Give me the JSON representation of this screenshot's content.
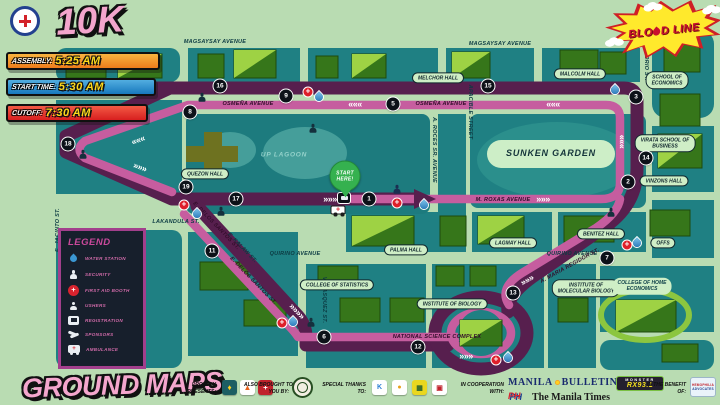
{
  "page": {
    "bg": "#b9dcb2",
    "map_teal": "#1f8083",
    "route_purple": "#571f4e",
    "route_pink": "#c65d9f"
  },
  "header": {
    "distance_badge": "10K",
    "schedule": [
      {
        "label": "ASSEMBLY:",
        "time": "5:25 AM",
        "c1": "#f9b43f",
        "c2": "#ee7c1b",
        "y": 52,
        "w": 154
      },
      {
        "label": "START TIME:",
        "time": "5:30 AM",
        "c1": "#52aee0",
        "c2": "#1878bd",
        "y": 78,
        "w": 150
      },
      {
        "label": "CUTOFF:",
        "time": "7:30 AM",
        "c1": "#f25a44",
        "c2": "#d81f1f",
        "y": 104,
        "w": 142
      }
    ]
  },
  "event_logo": {
    "t1": "BLO",
    "t2": "D LINE"
  },
  "legend": {
    "title": "LEGEND",
    "items": [
      {
        "icon": "water",
        "label": "WATER STATION"
      },
      {
        "icon": "security",
        "label": "SECURITY"
      },
      {
        "icon": "firstaid",
        "label": "FIRST AID BOOTH"
      },
      {
        "icon": "usher",
        "label": "USHERS"
      },
      {
        "icon": "registration",
        "label": "REGISTRATION"
      },
      {
        "icon": "sponsors",
        "label": "SPONSORS"
      },
      {
        "icon": "ambulance",
        "label": "AMBULANCE"
      }
    ]
  },
  "map": {
    "street_labels": [
      {
        "t": "MAGSAYSAY AVENUE",
        "x": 215,
        "y": 42,
        "r": 0,
        "v": "g"
      },
      {
        "t": "MAGSAYSAY AVENUE",
        "x": 500,
        "y": 44,
        "r": 0,
        "v": "g"
      },
      {
        "t": "OSMEÑA AVENUE",
        "x": 248,
        "y": 104,
        "r": 0,
        "v": "p"
      },
      {
        "t": "OSMEÑA AVENUE",
        "x": 441,
        "y": 104,
        "r": 0,
        "v": "p"
      },
      {
        "t": "M. ROXAS AVENUE",
        "x": 503,
        "y": 200,
        "r": 0,
        "v": "p"
      },
      {
        "t": "NATIONAL SCIENCE COMPLEX",
        "x": 437,
        "y": 337,
        "r": 0,
        "v": "p"
      },
      {
        "t": "LAKANDULA ST.",
        "x": 176,
        "y": 222,
        "r": 0,
        "v": "g"
      },
      {
        "t": "QUIRINO AVENUE",
        "x": 295,
        "y": 254,
        "r": 0,
        "v": "g"
      },
      {
        "t": "QUIRINO AVENUE",
        "x": 572,
        "y": 254,
        "r": 0,
        "v": "g"
      },
      {
        "t": "E. JACINTO ST.",
        "x": 58,
        "y": 230,
        "r": -90,
        "v": "g"
      },
      {
        "t": "A. ROCES SR. AVENUE",
        "x": 434,
        "y": 150,
        "r": 90,
        "v": "g"
      },
      {
        "t": "APACIBLE STREET",
        "x": 470,
        "y": 112,
        "r": 90,
        "v": "g"
      },
      {
        "t": "E. OSORIO ST.",
        "x": 646,
        "y": 60,
        "r": 90,
        "v": "g"
      },
      {
        "t": "VELASQUEZ ST.",
        "x": 324,
        "y": 300,
        "r": 90,
        "v": "g"
      },
      {
        "t": "E. KALAW ST.",
        "x": 242,
        "y": 248,
        "r": 46,
        "v": "g"
      },
      {
        "t": "E. DELOS SANTOS ST.",
        "x": 216,
        "y": 226,
        "r": 46,
        "v": "p"
      },
      {
        "t": "E. DELOS SANTOS ST.",
        "x": 253,
        "y": 281,
        "r": 46,
        "v": "p"
      },
      {
        "t": "A. MARIA REGIDOR ST.",
        "x": 570,
        "y": 266,
        "r": -29,
        "v": "p"
      }
    ],
    "place_labels": [
      {
        "t": "QUEZON HALL",
        "x": 205,
        "y": 174
      },
      {
        "t": "MELCHOR HALL",
        "x": 438,
        "y": 78
      },
      {
        "t": "MALCOLM HALL",
        "x": 580,
        "y": 74
      },
      {
        "t": "SCHOOL OF|ECONOMICS",
        "x": 667,
        "y": 80
      },
      {
        "t": "VIRATA SCHOOL OF|BUSINESS",
        "x": 665,
        "y": 143
      },
      {
        "t": "VINZONS HALL",
        "x": 664,
        "y": 181
      },
      {
        "t": "OFFS",
        "x": 663,
        "y": 243
      },
      {
        "t": "PALMA HALL",
        "x": 406,
        "y": 250
      },
      {
        "t": "LAGMAY HALL",
        "x": 513,
        "y": 243
      },
      {
        "t": "BENITEZ HALL",
        "x": 601,
        "y": 234
      },
      {
        "t": "COLLEGE OF STATISTICS",
        "x": 337,
        "y": 285
      },
      {
        "t": "INSTITUTE OF BIOLOGY",
        "x": 452,
        "y": 304
      },
      {
        "t": "INSTITUTE OF|MOLECULAR BIOLOGY",
        "x": 586,
        "y": 288
      },
      {
        "t": "COLLEGE OF HOME|ECONOMICS",
        "x": 642,
        "y": 286,
        "v": "plain"
      },
      {
        "t": "SUNKEN GARDEN",
        "x": 551,
        "y": 153,
        "v": "big"
      },
      {
        "t": "UP LAGOON",
        "x": 284,
        "y": 155,
        "v": "water"
      }
    ],
    "markers": [
      {
        "n": "18",
        "x": 68,
        "y": 144
      },
      {
        "n": "19",
        "x": 186,
        "y": 187
      },
      {
        "n": "8",
        "x": 190,
        "y": 112
      },
      {
        "n": "16",
        "x": 220,
        "y": 86
      },
      {
        "n": "9",
        "x": 286,
        "y": 96
      },
      {
        "n": "5",
        "x": 393,
        "y": 104
      },
      {
        "n": "15",
        "x": 488,
        "y": 86
      },
      {
        "n": "3",
        "x": 636,
        "y": 97
      },
      {
        "n": "14",
        "x": 646,
        "y": 158
      },
      {
        "n": "2",
        "x": 628,
        "y": 182
      },
      {
        "n": "17",
        "x": 236,
        "y": 199
      },
      {
        "n": "1",
        "x": 369,
        "y": 199
      },
      {
        "n": "11",
        "x": 212,
        "y": 251
      },
      {
        "n": "6",
        "x": 324,
        "y": 337
      },
      {
        "n": "12",
        "x": 418,
        "y": 347
      },
      {
        "n": "13",
        "x": 513,
        "y": 293
      },
      {
        "n": "7",
        "x": 607,
        "y": 258
      }
    ],
    "icons": [
      {
        "k": "firstaid",
        "x": 308,
        "y": 92
      },
      {
        "k": "water",
        "x": 319,
        "y": 97
      },
      {
        "k": "firstaid",
        "x": 184,
        "y": 205
      },
      {
        "k": "water",
        "x": 197,
        "y": 214
      },
      {
        "k": "firstaid",
        "x": 397,
        "y": 203
      },
      {
        "k": "water",
        "x": 424,
        "y": 205
      },
      {
        "k": "firstaid",
        "x": 282,
        "y": 323
      },
      {
        "k": "water",
        "x": 293,
        "y": 322
      },
      {
        "k": "firstaid",
        "x": 496,
        "y": 360
      },
      {
        "k": "water",
        "x": 508,
        "y": 358
      },
      {
        "k": "firstaid",
        "x": 627,
        "y": 245
      },
      {
        "k": "water",
        "x": 637,
        "y": 243
      },
      {
        "k": "water",
        "x": 615,
        "y": 90
      },
      {
        "k": "security",
        "x": 202,
        "y": 97
      },
      {
        "k": "security",
        "x": 313,
        "y": 128
      },
      {
        "k": "security",
        "x": 83,
        "y": 154
      },
      {
        "k": "security",
        "x": 221,
        "y": 211
      },
      {
        "k": "security",
        "x": 311,
        "y": 322
      },
      {
        "k": "security",
        "x": 611,
        "y": 212
      },
      {
        "k": "usher",
        "x": 342,
        "y": 182
      },
      {
        "k": "registration",
        "x": 344,
        "y": 198
      },
      {
        "k": "ambulance",
        "x": 338,
        "y": 210
      },
      {
        "k": "statue",
        "x": 397,
        "y": 189
      }
    ],
    "start_pin": {
      "l1": "START",
      "l2": "HERE!",
      "x": 345,
      "y": 176
    },
    "chevrons": [
      {
        "t": "«««",
        "x": 355,
        "y": 104,
        "r": 0
      },
      {
        "t": "«««",
        "x": 553,
        "y": 104,
        "r": 0
      },
      {
        "t": "«««",
        "x": 138,
        "y": 140,
        "r": -20
      },
      {
        "t": "»»»",
        "x": 140,
        "y": 167,
        "r": 20
      },
      {
        "t": "»»»",
        "x": 330,
        "y": 199,
        "r": 0
      },
      {
        "t": "»»»",
        "x": 543,
        "y": 199,
        "r": 0
      },
      {
        "t": "»»»»",
        "x": 297,
        "y": 311,
        "r": 46
      },
      {
        "t": "»»»",
        "x": 466,
        "y": 356,
        "r": 0
      },
      {
        "t": "»»»",
        "x": 527,
        "y": 280,
        "r": -29
      },
      {
        "t": "»»»",
        "x": 621,
        "y": 142,
        "r": -90
      }
    ]
  },
  "footer": {
    "title": "GROUND MAPS",
    "sections": [
      {
        "l1": "PROUDLY",
        "l2": "PRESENTS:"
      },
      {
        "l1": "ALSO BROUGHT TO",
        "l2": "YOU BY:"
      },
      {
        "l1": "SPECIAL THANKS",
        "l2": "TO:"
      },
      {
        "l1": "IN COOPERATION",
        "l2": "WITH:"
      },
      {
        "l1": "IN THE BENEFIT",
        "l2": "OF:"
      }
    ],
    "bulletin1": "MANILA",
    "bulletin2": "BULLETIN",
    "times": "The Manila Times",
    "rx1": "MONSTER",
    "rx2": "RX93.1",
    "ph": "PH",
    "benefit": {
      "l1": "HEMOPHILIA",
      "l2": "ADVOCATES"
    }
  }
}
